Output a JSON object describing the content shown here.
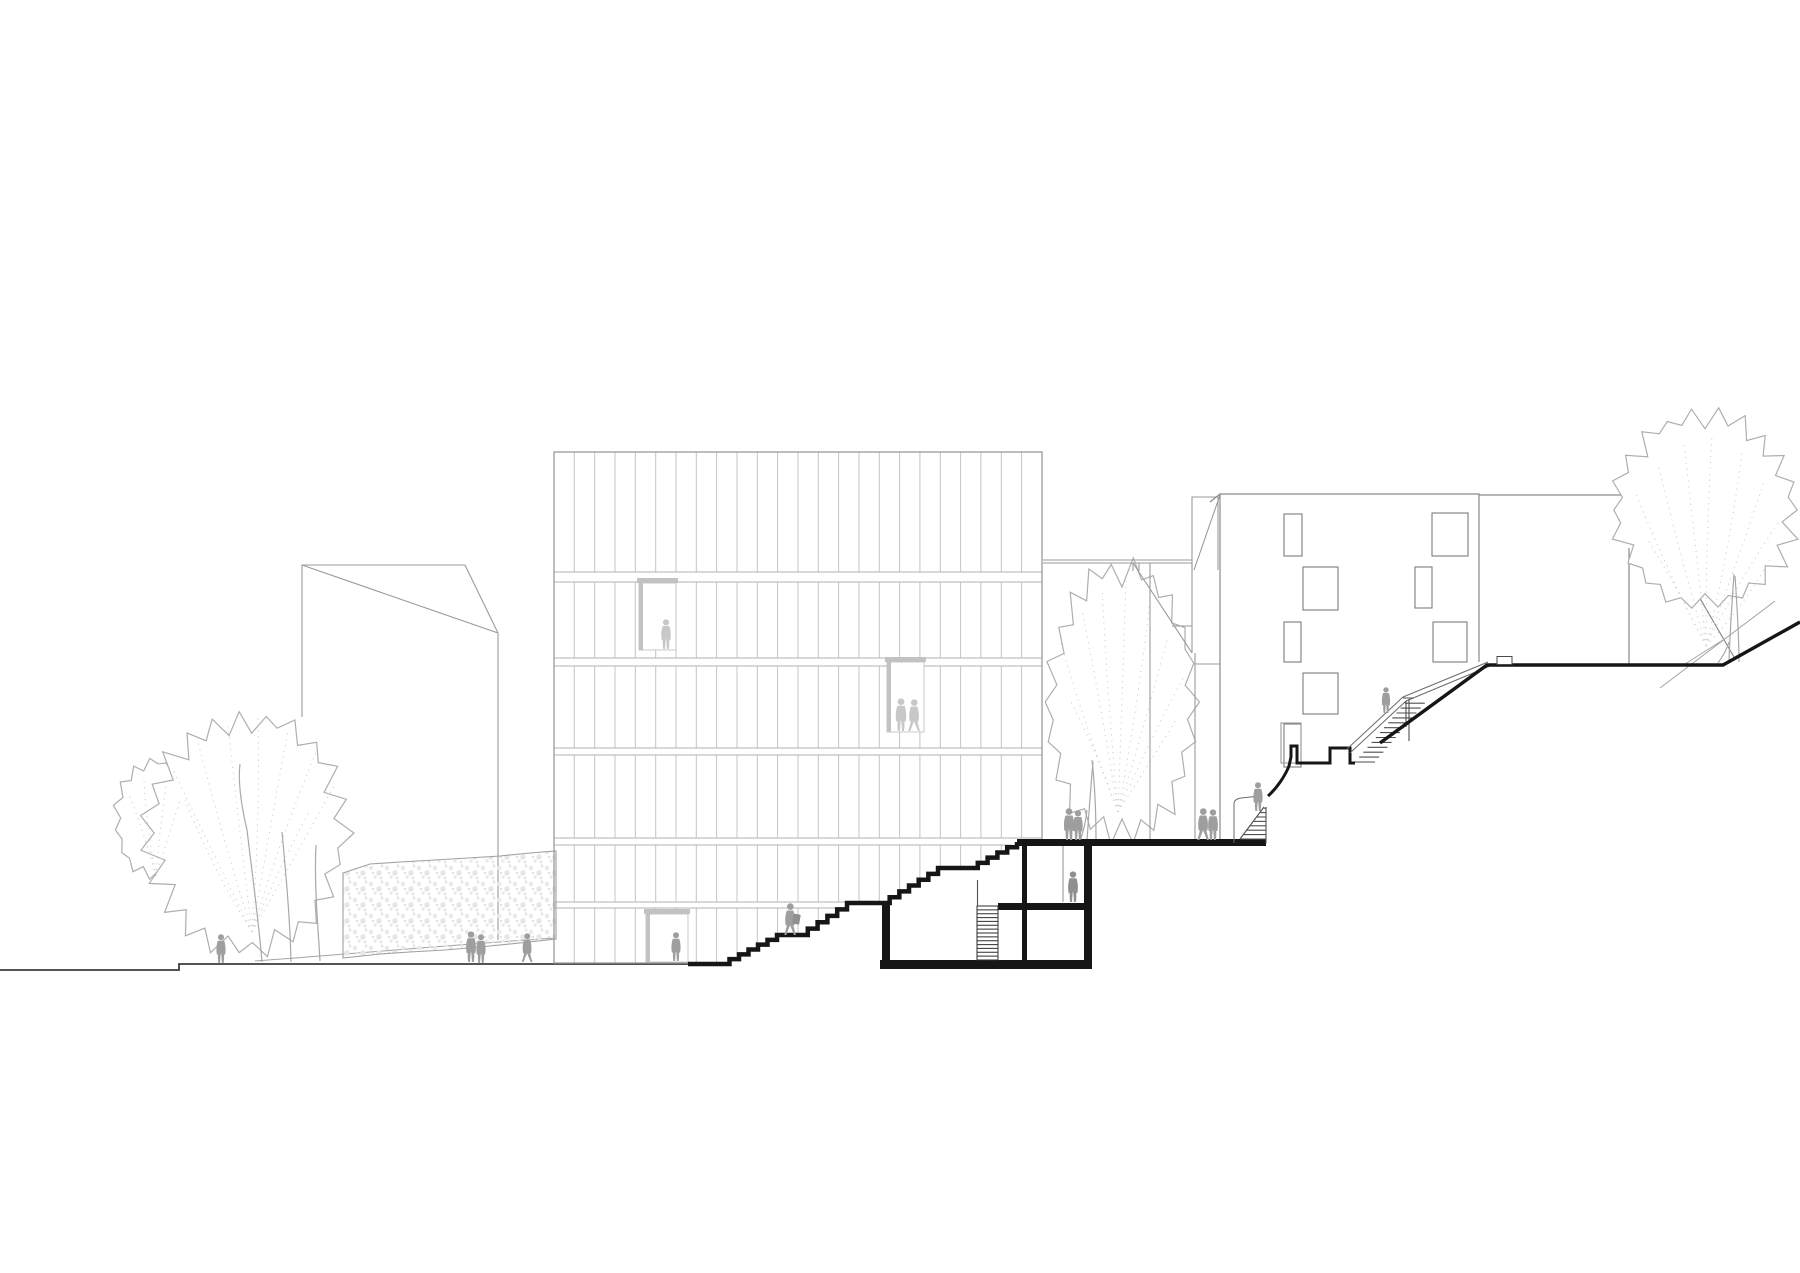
{
  "meta": {
    "title": "Architectural site section and elevation drawing",
    "scene_label": "Cross-section through a hillside site: slatted timber building, sunken plaza with basement, stairs climbing to upper street",
    "background": "#ffffff"
  },
  "palette": {
    "cut_black": "#161616",
    "ground_line": "#3c3c3c",
    "building_line": "#8a8a8a",
    "light_line": "#9a9a9a",
    "slat_line": "#c4c4c4",
    "band_line": "#b2b2b2",
    "tree_line": "#aeaeae",
    "vein_dot": "#cfcfcf",
    "people_dark": "#9e9e9e",
    "people_mid": "#8f8f8f",
    "people_light": "#c8c8c8",
    "stipple": "#e7e7e7"
  },
  "labels": {
    "scene": "Site section: new building with slatted facade, sunken plaza, hillside stairs",
    "left_building": "Background gabled building (left)",
    "left_trees": "Street trees (left)",
    "hedge_wall": "Stippled garden wall / hedge",
    "main_building": "Main building - vertical slat facade",
    "grand_stairs": "Sectioned outdoor stair cascade",
    "plaza_deck": "Raised plaza deck (section cut)",
    "basement": "Sectioned basement rooms with stair",
    "courtyard_tree": "Courtyard tree behind plaza",
    "middle_building": "Background building with sloped roof (middle)",
    "right_building": "Neighbouring building with window grid",
    "hillside_stairs": "Hillside stair with railing",
    "upper_ground": "Upper street level ground cut",
    "right_tree": "Tree on upper slope",
    "people": "Scale figures"
  },
  "facade": {
    "x1": 554,
    "x2": 1042,
    "top": 452,
    "bottom": 963,
    "slat_spacing": 20.33,
    "bands": [
      [
        572,
        582
      ],
      [
        658,
        666
      ],
      [
        748,
        755
      ],
      [
        838,
        845
      ],
      [
        902,
        908
      ]
    ]
  },
  "grand_stair": {
    "landings": [
      [
        688,
        720,
        964
      ],
      [
        777,
        798,
        935
      ],
      [
        847,
        880,
        903
      ],
      [
        938,
        968,
        868
      ]
    ],
    "runs": [
      [
        720,
        964,
        777,
        935,
        6
      ],
      [
        798,
        935,
        847,
        903,
        5
      ],
      [
        880,
        903,
        938,
        868,
        6
      ],
      [
        968,
        868,
        1017,
        842,
        5
      ]
    ],
    "stroke_width": 4.5
  },
  "deck": {
    "x1": 1017,
    "x2": 1266,
    "y": 839,
    "h": 7
  },
  "basement": {
    "left_wall": [
      882,
      901,
      8,
      62
    ],
    "bottom_slab": [
      880,
      960,
      212,
      9
    ],
    "right_wall": [
      1084,
      839,
      8,
      130
    ],
    "inner_wall": [
      1022,
      846,
      5,
      118
    ],
    "mid_slab": [
      998,
      903,
      94,
      7
    ],
    "stair": {
      "x": 977,
      "y": 906,
      "w": 21,
      "h": 54,
      "lines": 13
    },
    "handrail": [
      977.5,
      880,
      977.5,
      906
    ],
    "door_line": [
      1063,
      846,
      1063,
      902
    ]
  },
  "hatch_stairs": [
    {
      "id": "deck-end-stair-treads",
      "x0": 1240,
      "y0": 839,
      "dx": 3.4,
      "dy": -4.4,
      "n": 8,
      "x2": 1266
    },
    {
      "id": "hillside-stair-treads",
      "x0": 1355,
      "y0": 762,
      "dx": 4.15,
      "dy": -4.9,
      "n": 13,
      "len": 20
    }
  ],
  "right_building_windows": [
    [
      1284,
      514,
      18,
      42
    ],
    [
      1432,
      513,
      36,
      43
    ],
    [
      1303,
      567,
      35,
      43
    ],
    [
      1415,
      567,
      17,
      41
    ],
    [
      1284,
      622,
      17,
      40
    ],
    [
      1433,
      622,
      34,
      40
    ],
    [
      1303,
      673,
      35,
      41
    ],
    [
      1284,
      724,
      17,
      43
    ]
  ],
  "canopies": [
    {
      "id": "left-small-canopy",
      "cx": 154,
      "cy": 818,
      "rx": 42,
      "ry": 62,
      "n": 30,
      "seed": 3
    },
    {
      "id": "left-big-canopy",
      "cx": 246,
      "cy": 833,
      "rx": 106,
      "ry": 127,
      "n": 46,
      "seed": 7
    },
    {
      "id": "courtyard-canopy",
      "cx": 1122,
      "cy": 702,
      "rx": 80,
      "ry": 147,
      "n": 44,
      "seed": 11
    },
    {
      "id": "right-canopy",
      "cx": 1705,
      "cy": 510,
      "rx": 97,
      "ry": 104,
      "n": 44,
      "seed": 5
    }
  ],
  "veins": [
    {
      "base": [
        252,
        932
      ],
      "seed": 21,
      "tips": [
        [
          172,
          768
        ],
        [
          198,
          742
        ],
        [
          228,
          726
        ],
        [
          258,
          718
        ],
        [
          288,
          730
        ],
        [
          316,
          752
        ],
        [
          334,
          786
        ],
        [
          185,
          800
        ],
        [
          310,
          810
        ]
      ]
    },
    {
      "base": [
        156,
        876
      ],
      "seed": 22,
      "tips": [
        [
          128,
          792
        ],
        [
          144,
          780
        ],
        [
          166,
          786
        ],
        [
          180,
          800
        ]
      ]
    },
    {
      "base": [
        1118,
        812
      ],
      "seed": 23,
      "tips": [
        [
          1060,
          640
        ],
        [
          1082,
          610
        ],
        [
          1102,
          588
        ],
        [
          1126,
          578
        ],
        [
          1150,
          600
        ],
        [
          1168,
          636
        ],
        [
          1184,
          676
        ],
        [
          1070,
          700
        ],
        [
          1176,
          720
        ]
      ]
    },
    {
      "base": [
        1706,
        646
      ],
      "seed": 24,
      "tips": [
        [
          1636,
          494
        ],
        [
          1658,
          464
        ],
        [
          1684,
          444
        ],
        [
          1712,
          436
        ],
        [
          1742,
          452
        ],
        [
          1764,
          482
        ],
        [
          1780,
          520
        ],
        [
          1648,
          540
        ],
        [
          1772,
          556
        ]
      ]
    }
  ],
  "people": [
    {
      "x": 221,
      "y": 963,
      "h": 29,
      "variant": "stand",
      "shade": "dark"
    },
    {
      "x": 471,
      "y": 962,
      "h": 31,
      "variant": "stand",
      "shade": "dark"
    },
    {
      "x": 481,
      "y": 963,
      "h": 29,
      "variant": "stand",
      "shade": "dark"
    },
    {
      "x": 527,
      "y": 962,
      "h": 29,
      "variant": "walk",
      "shade": "dark"
    },
    {
      "x": 676,
      "y": 961,
      "h": 29,
      "variant": "stand",
      "shade": "dark"
    },
    {
      "x": 790,
      "y": 935,
      "h": 32,
      "variant": "walk",
      "shade": "dark",
      "bag": true
    },
    {
      "x": 1069,
      "y": 840,
      "h": 32,
      "variant": "stand",
      "shade": "dark"
    },
    {
      "x": 1078,
      "y": 840,
      "h": 30,
      "variant": "stand",
      "shade": "dark"
    },
    {
      "x": 1203,
      "y": 840,
      "h": 32,
      "variant": "walk",
      "shade": "dark"
    },
    {
      "x": 1213,
      "y": 840,
      "h": 31,
      "variant": "stand",
      "shade": "dark"
    },
    {
      "x": 1258,
      "y": 811,
      "h": 29,
      "variant": "stand",
      "shade": "dark"
    },
    {
      "x": 1386,
      "y": 713,
      "h": 26,
      "variant": "stand",
      "shade": "dark"
    },
    {
      "x": 1073,
      "y": 902,
      "h": 31,
      "variant": "stand",
      "shade": "mid"
    },
    {
      "x": 666,
      "y": 649,
      "h": 30,
      "variant": "stand",
      "shade": "light"
    },
    {
      "x": 901,
      "y": 731,
      "h": 33,
      "variant": "stand",
      "shade": "light"
    },
    {
      "x": 914,
      "y": 731,
      "h": 32,
      "variant": "walk",
      "shade": "light"
    }
  ]
}
